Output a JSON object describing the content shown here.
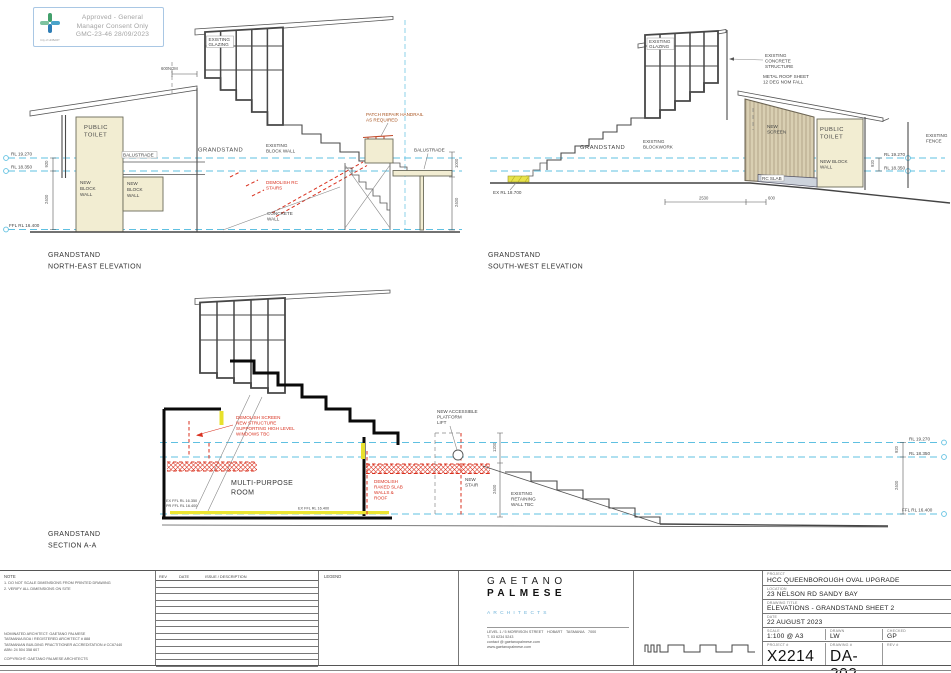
{
  "stamp": {
    "line1": "Approved - General",
    "line2": "Manager Consent Only",
    "line3": "GMC-23-46 28/09/2023",
    "logo_caption": "City of HOBART"
  },
  "ne": {
    "title": [
      "GRANDSTAND",
      "NORTH-EAST ELEVATION"
    ],
    "glazing": [
      "EXISTING",
      "GLAZING"
    ],
    "toilet": [
      "PUBLIC",
      "TOILET"
    ],
    "nbw1": [
      "NEW",
      "BLOCK",
      "WALL"
    ],
    "nbw2": [
      "NEW",
      "BLOCK",
      "WALL"
    ],
    "balustrade_left": "BALUSTRADE",
    "balustrade_right": "BALUSTRADE",
    "grandstand": "GRANDSTAND",
    "ebw": [
      "EXISTING",
      "BLOCK WALL"
    ],
    "demo_stairs": [
      "DEMOLISH RC",
      "STAIRS"
    ],
    "concrete_wall": [
      "CONCRETE",
      "WALL"
    ],
    "patch": [
      "PATCH REPAIR HANDRAIL",
      "AS REQUIRED"
    ],
    "dim600": "600NOM",
    "rl1": "RL 19.270",
    "rl2": "RL 18.350",
    "ffl": "FFL RL 16.400",
    "d920": "920",
    "d2400": "2400",
    "d1000": "1000",
    "d2400b": "2400"
  },
  "sw": {
    "title": [
      "GRANDSTAND",
      "SOUTH-WEST ELEVATION"
    ],
    "glazing": [
      "EXISTING",
      "GLAZING"
    ],
    "concrete": [
      "EXISTING",
      "CONCRETE",
      "STRUCTURE"
    ],
    "metal_roof": [
      "METAL ROOF SHEET",
      "12 DEG NOM FALL"
    ],
    "new_screen": [
      "NEW",
      "SCREEN"
    ],
    "toilet": [
      "PUBLIC",
      "TOILET"
    ],
    "nbw": [
      "NEW BLOCK",
      "WALL"
    ],
    "fence": [
      "EXISTING",
      "FENCE"
    ],
    "grandstand": "GRANDSTAND",
    "blockwork": [
      "EXISTING",
      "BLOCKWORK"
    ],
    "rc_slab": "RC SLAB",
    "ex_rl": "EX RL 18.700",
    "rl1": "RL 19.270",
    "rl2": "RL 18.350",
    "d920": "920",
    "d2530": "2530",
    "d600": "600"
  },
  "section": {
    "title": [
      "GRANDSTAND",
      "SECTION A-A"
    ],
    "demo_screen": [
      "DEMOLISH SCREEN",
      "NEW STRUCTURE",
      "SUPPORTING HIGH LEVEL",
      "WINDOWS TBC"
    ],
    "room": [
      "MULTI-PURPOSE",
      "ROOM"
    ],
    "demo_slab": [
      "DEMOLISH",
      "RAKED SLAB",
      "WALLS &",
      "ROOF"
    ],
    "lift": [
      "NEW ACCESSIBLE",
      "PLATFORM",
      "LIFT"
    ],
    "new_stair": [
      "NEW",
      "STAIR"
    ],
    "retaining": [
      "EXISTING",
      "RETAINING",
      "WALL TBC"
    ],
    "ex_ffl_left": [
      "EX FFL RL 16.350",
      "PR FFL RL 16.400"
    ],
    "ex_ffl_mid": "EX FFL RL 16.400",
    "rl1": "RL 19.270",
    "rl2": "RL 18.350",
    "ffl": "FFL RL 16.400",
    "d1200": "1200",
    "d2400": "2400",
    "d920": "920",
    "d2400r": "2400"
  },
  "titleblock": {
    "brand1": "GAETANO",
    "brand2": "PALMESE",
    "brand3": "ARCHITECTS",
    "address": [
      "LEVEL 1 / 5 MORRISON STREET　HOBART　TASMANIA　7000",
      "T.  03 6234 5243",
      "contact @ gaetanopalmese.com",
      "www.gaetanopalmese.com"
    ],
    "fields": {
      "project_label": "PROJECT",
      "project": "HCC QUEENBOROUGH OVAL UPGRADE",
      "location_label": "LOCATION",
      "location": "23 NELSON RD SANDY BAY",
      "title_label": "DRAWING TITLE",
      "title": "ELEVATIONS - GRANDSTAND SHEET 2",
      "date_label": "DATE",
      "date": "22 AUGUST 2023",
      "scale_label": "SCALE",
      "scale": "1:100 @ A3",
      "drawn_label": "DRAWN",
      "drawn": "LW",
      "checked_label": "CHECKED",
      "checked": "GP",
      "project_no_label": "PROJECT #",
      "project_no": "X2214",
      "drawing_no_label": "DRAWING #",
      "drawing_no": "DA-202",
      "rev_no_label": "REV #",
      "rev_no": ""
    }
  },
  "notes": {
    "header": "NOTE",
    "items": [
      "1. DO NOT SCALE DIMENSIONS FROM PRINTED DRAWING",
      "2. VERIFY ALL DIMENSIONS ON SITE"
    ],
    "rev_headers": [
      "REV",
      "DATE",
      "ISSUE / DESCRIPTION"
    ],
    "legend_label": "LEGEND",
    "architect": [
      "NOMINATED ARCHITECT: GAETANO PALMESE",
      "TASMANIA BOA / REGISTERED ARCHITECT # 888",
      "TASMANIAN BUILDING PRACTITIONER ACCREDITATION # CC67440",
      "ABN: 24 504 358 607"
    ],
    "copyright": "COPYRIGHT: GAETANO PALMESE ARCHITECTS"
  },
  "colors": {
    "level_line_cyan": "#5fc0e1",
    "demolition_red": "#d9311f",
    "wall_cream": "#f2edd2",
    "screen_tan": "#d9cfb2",
    "highlight_yellow": "#ece531",
    "brand_blue": "#6fb3d9",
    "stamp_border_blue": "#a9c7e4"
  }
}
